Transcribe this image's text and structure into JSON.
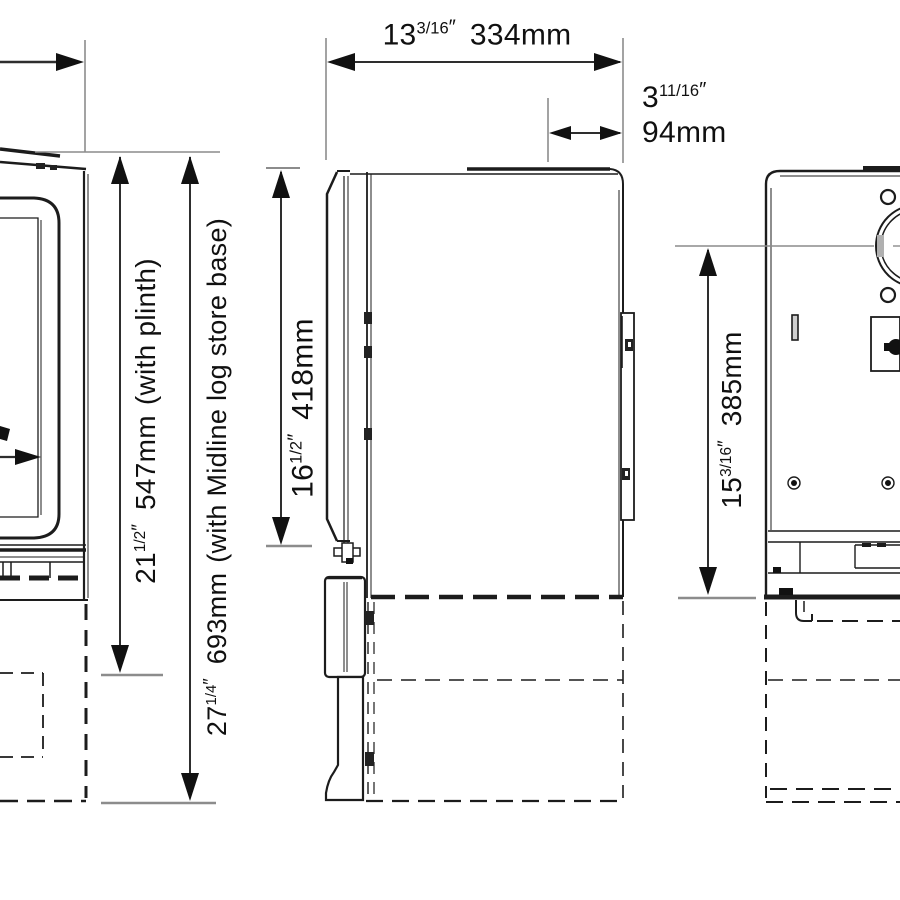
{
  "dimensions": {
    "depth_overall": {
      "inches_whole": "13",
      "inches_fraction": "3/16",
      "inch_mark": "″",
      "metric": "334mm"
    },
    "flue_centre_to_rear": {
      "inches_whole": "3",
      "inches_fraction": "11/16",
      "inch_mark": "″",
      "metric": "94mm"
    },
    "height_with_plinth": {
      "inches_whole": "21",
      "inches_fraction": "1/2",
      "inch_mark": "″",
      "metric": "547mm",
      "note": "(with plinth)"
    },
    "height_with_log_store": {
      "inches_whole": "27",
      "inches_fraction": "1/4",
      "inch_mark": "″",
      "metric": "693mm",
      "note": "(with Midline log store base)"
    },
    "door_height": {
      "inches_whole": "16",
      "inches_fraction": "1/2",
      "inch_mark": "″",
      "metric": "418mm"
    },
    "flue_centre_height": {
      "inches_whole": "15",
      "inches_fraction": "3/16",
      "inch_mark": "″",
      "metric": "385mm"
    }
  },
  "colors": {
    "drawing_line": "#1c1c1c",
    "dimension_line": "#2e2e2e",
    "extension_line": "#8c8c8c",
    "arrowhead": "#111111",
    "background": "#ffffff"
  }
}
